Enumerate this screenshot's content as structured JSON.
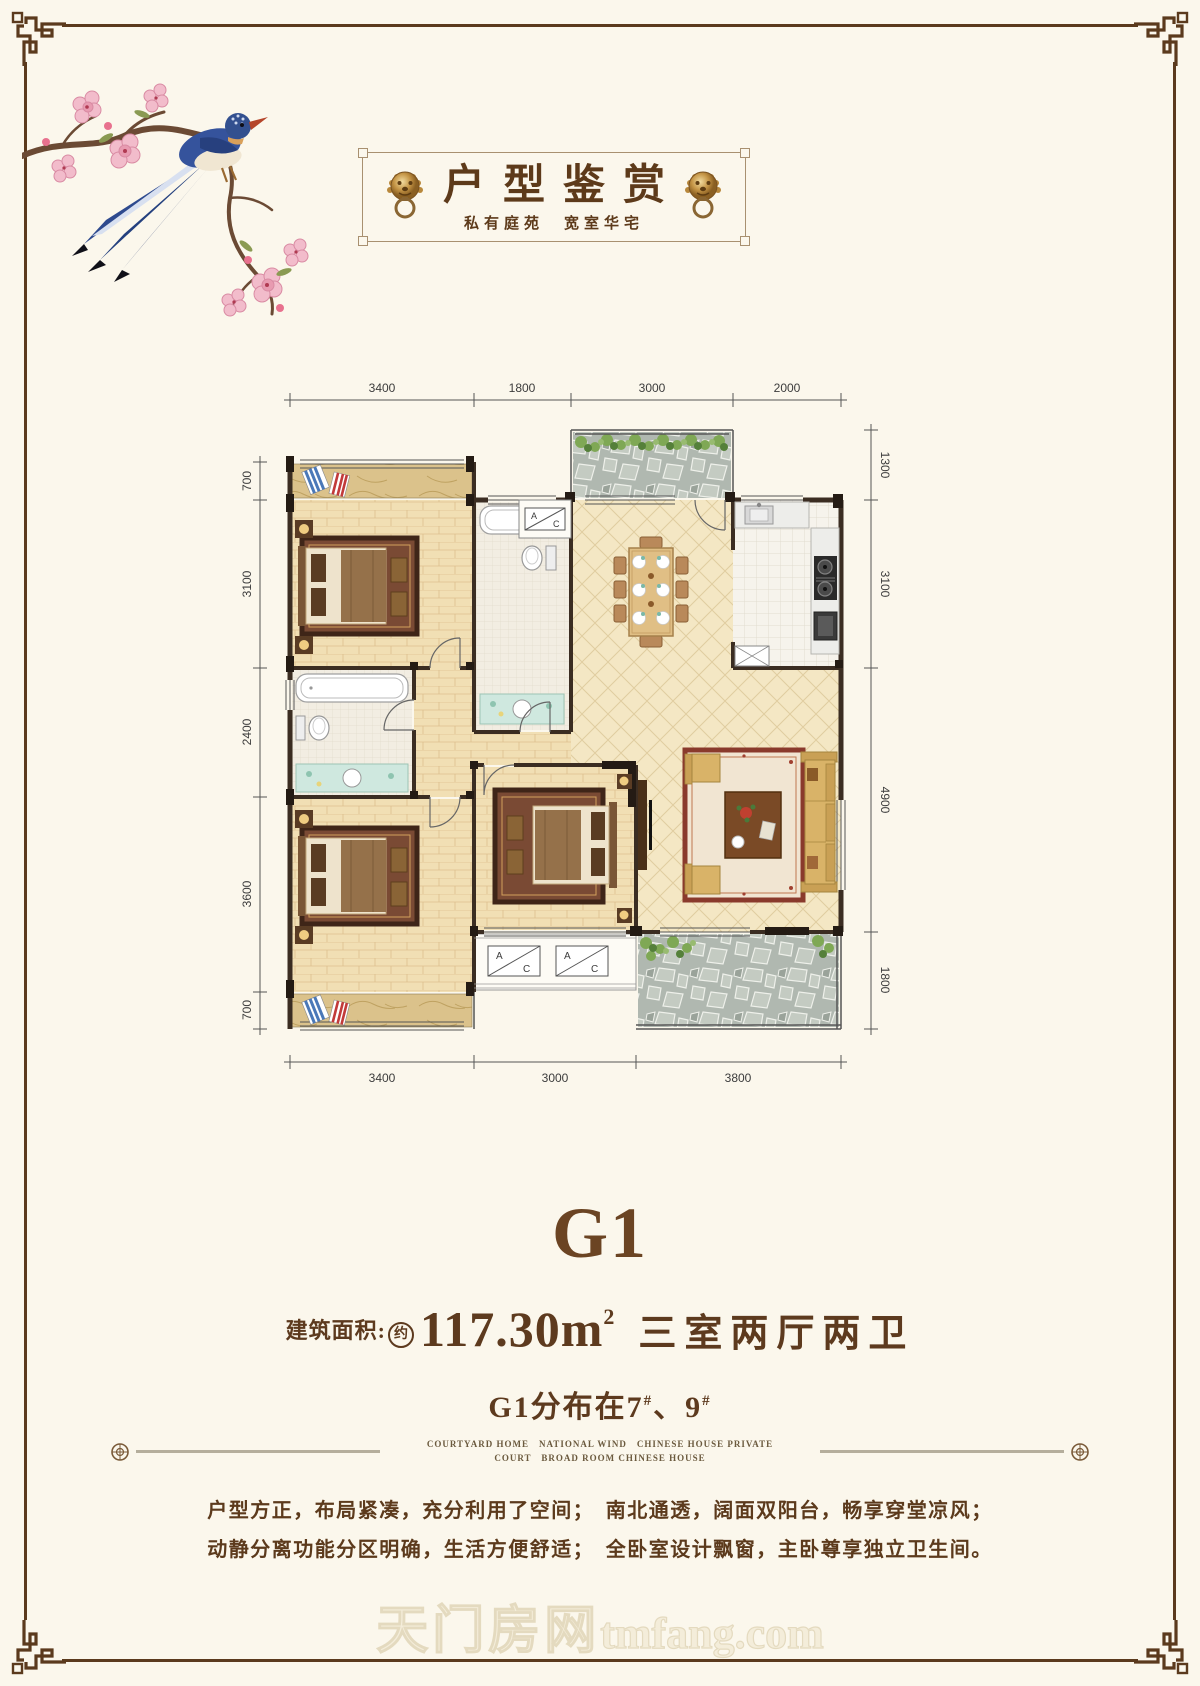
{
  "page": {
    "colors": {
      "background": "#fbf7ec",
      "frame": "#5b3a1d",
      "text_brown": "#5d3a1e",
      "wall": "#3b2d22",
      "gold": "#c9a063"
    }
  },
  "banner": {
    "title": "户型鉴赏",
    "subtitle": "私有庭苑　宽室华宅"
  },
  "floorplan": {
    "dims_top": [
      "3400",
      "1800",
      "3000",
      "2000"
    ],
    "dims_left": [
      "700",
      "3100",
      "2400",
      "3600",
      "700"
    ],
    "dims_right": [
      "1300",
      "3100",
      "4900",
      "1800"
    ],
    "dims_bottom": [
      "3400",
      "3000",
      "3800"
    ],
    "ac_a": "A",
    "ac_c": "C"
  },
  "unit": {
    "name": "G1",
    "area_label": "建筑面积:",
    "area_approx": "约",
    "area_value": "117.30m",
    "area_sup": "2",
    "rooms": "三室两厅两卫",
    "dist_prefix": "G1分布在7",
    "dist_hash1": "#",
    "dist_mid": "、9",
    "dist_hash2": "#"
  },
  "divider": {
    "line1": "COURTYARD HOME　NATIONAL WIND　CHINESE HOUSE PRIVATE",
    "line2": "COURT　BROAD ROOM CHINESE HOUSE"
  },
  "description": {
    "line1": "户型方正，布局紧凑，充分利用了空间；　南北通透，阔面双阳台，畅享穿堂凉风；",
    "line2": "动静分离功能分区明确，生活方便舒适；　全卧室设计飘窗，主卧尊享独立卫生间。"
  },
  "watermark": {
    "cn": "天门房网",
    "en": "tmfang.com"
  }
}
